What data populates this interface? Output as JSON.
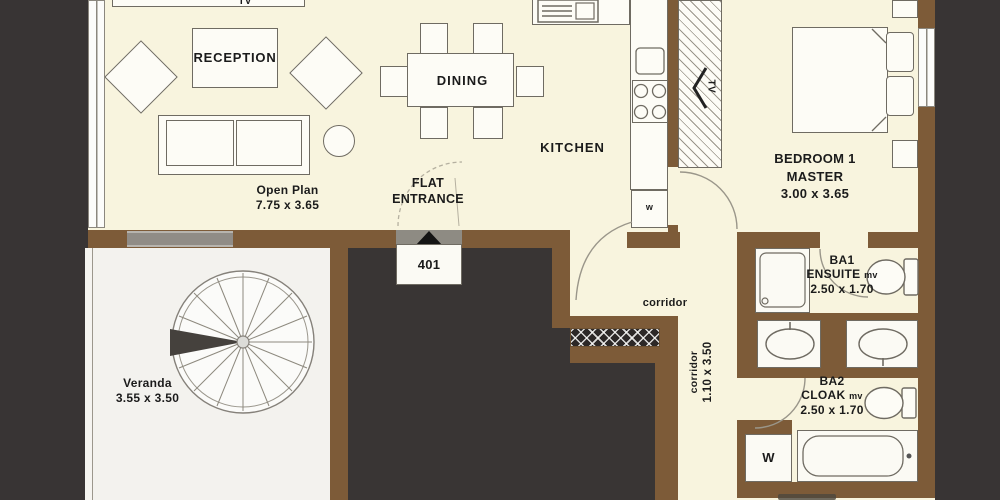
{
  "title": "Flat 401 Floor Plan",
  "colors": {
    "wall": "#7d5b38",
    "floor": "#f8f4de",
    "veranda_floor": "#f3f2ee",
    "outside": "#393534",
    "glass": "#908c86",
    "line": "#6f6b62"
  },
  "rooms": {
    "reception": "RECEPTION",
    "dining": "DINING",
    "kitchen": "KITCHEN",
    "open_plan": {
      "name": "Open Plan",
      "dims": "7.75 x 3.65"
    },
    "flat_entrance": {
      "line1": "FLAT",
      "line2": "ENTRANCE",
      "unit": "401"
    },
    "corridor": {
      "name": "corridor"
    },
    "corridor_vertical": {
      "name": "corridor",
      "dims": "1.10 x 3.50"
    },
    "bedroom1": {
      "name": "BEDROOM 1",
      "subtitle": "MASTER",
      "dims": "3.00 x 3.65"
    },
    "ba1": {
      "name": "BA1",
      "subtitle": "ENSUITE",
      "vent": "mv",
      "dims": "2.50 x 1.70"
    },
    "ba2": {
      "name": "BA2",
      "subtitle": "CLOAK",
      "vent": "mv",
      "dims": "2.50 x 1.70"
    },
    "veranda": {
      "name": "Veranda",
      "dims": "3.55 x 3.50"
    }
  },
  "fixtures": {
    "tv_lounge": "TV",
    "tv_bedroom": "TV",
    "washer_kitchen": "w",
    "washer_ba2": "W"
  }
}
